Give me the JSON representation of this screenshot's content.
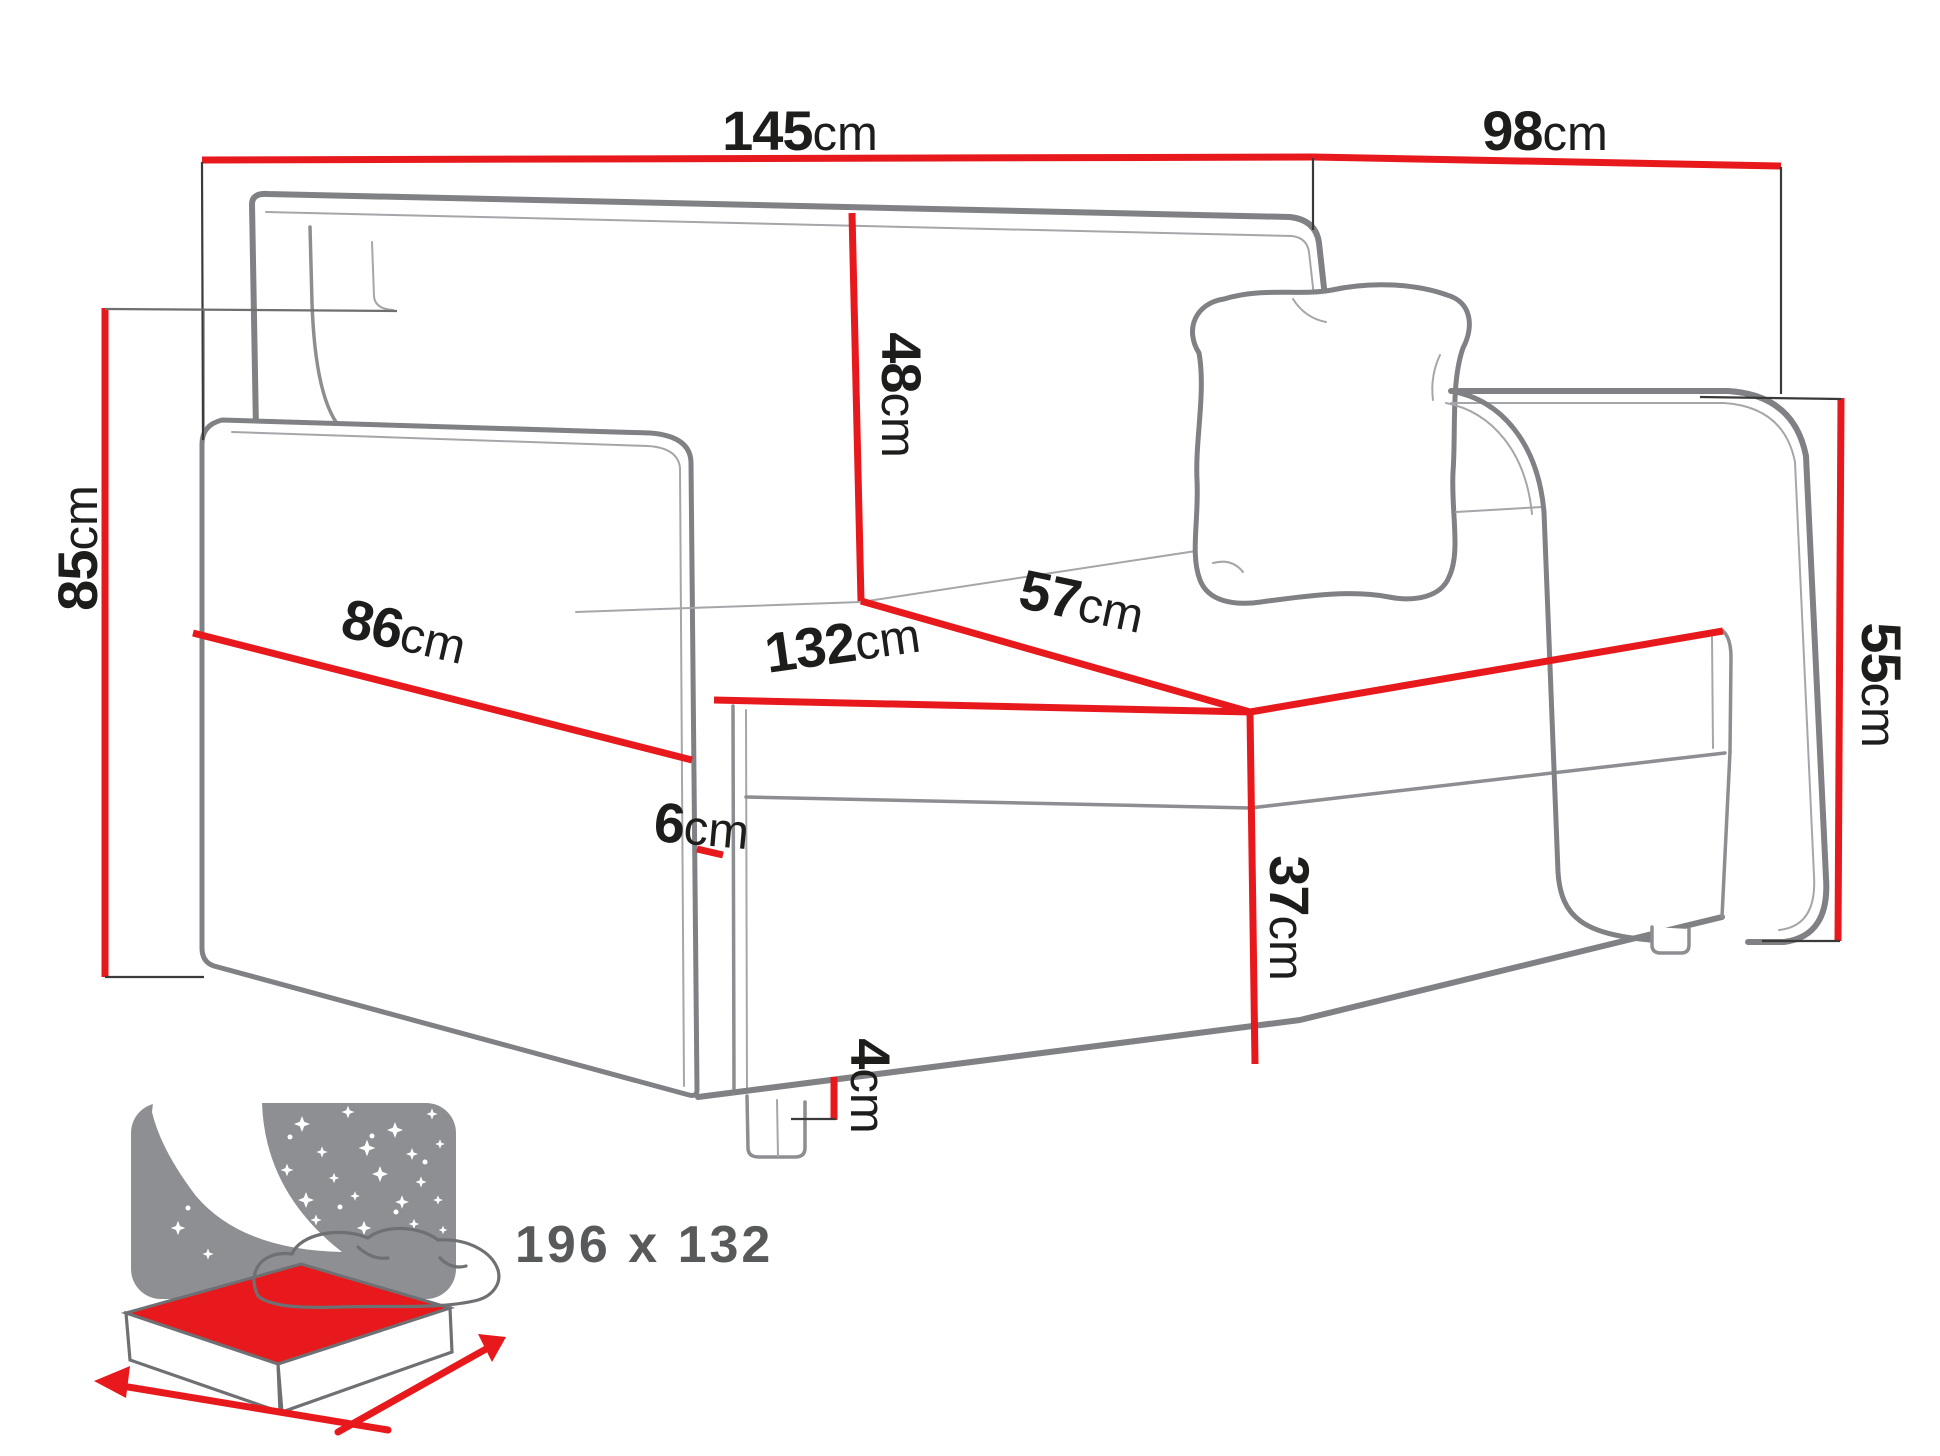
{
  "diagram": {
    "type": "sofa-bed dimension drawing",
    "colors": {
      "dimension_red": "#e8191d",
      "label_text": "#1d1d1b",
      "sofa_outline": "#7f8184",
      "icon_gray": "#8d8f92",
      "icon_text": "#58595b"
    },
    "dimensions": {
      "overall_width": {
        "value": "145",
        "unit": "cm"
      },
      "overall_depth": {
        "value": "98",
        "unit": "cm"
      },
      "overall_height": {
        "value": "85",
        "unit": "cm"
      },
      "backrest_height": {
        "value": "48",
        "unit": "cm"
      },
      "seat_depth": {
        "value": "57",
        "unit": "cm"
      },
      "seat_width": {
        "value": "132",
        "unit": "cm"
      },
      "side_depth": {
        "value": "86",
        "unit": "cm"
      },
      "armrest_thickness excluded_note": {
        "value": "6",
        "unit": "cm"
      },
      "armrest_thickness": {
        "value": "6",
        "unit": "cm"
      },
      "armrest_height": {
        "value": "55",
        "unit": "cm"
      },
      "seat_height": {
        "value": "37",
        "unit": "cm"
      },
      "leg_height": {
        "value": "4",
        "unit": "cm"
      }
    },
    "sleeping_area": {
      "label": "196 x 132",
      "icon": "sofa-bed-sleeping-function-icon"
    }
  }
}
